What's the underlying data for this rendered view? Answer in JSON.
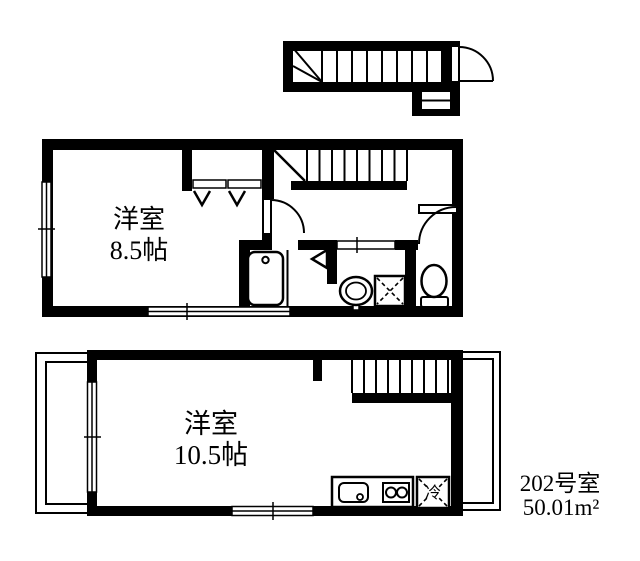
{
  "background_color": "#ffffff",
  "line_color": "#000000",
  "entrance": {
    "features": [
      "winder-staircase",
      "entrance-door",
      "porch-step"
    ]
  },
  "upper_plan": {
    "room_name": "洋室",
    "room_size": "8.5帖",
    "features": [
      "closet-with-hangers",
      "staircase",
      "hall-doors",
      "bathtub",
      "washbasin",
      "washing-machine-space",
      "toilet",
      "sliding-windows",
      "bath-sliding-door"
    ]
  },
  "lower_plan": {
    "room_name": "洋室",
    "room_size": "10.5帖",
    "refrigerator_label": "冷",
    "features": [
      "balcony-left",
      "balcony-right",
      "staircase",
      "kitchen-counter",
      "kitchen-sink",
      "two-burner-stove",
      "refrigerator-space",
      "sliding-windows"
    ]
  },
  "unit": {
    "room_number": "202号室",
    "floor_area": "50.01m²"
  }
}
